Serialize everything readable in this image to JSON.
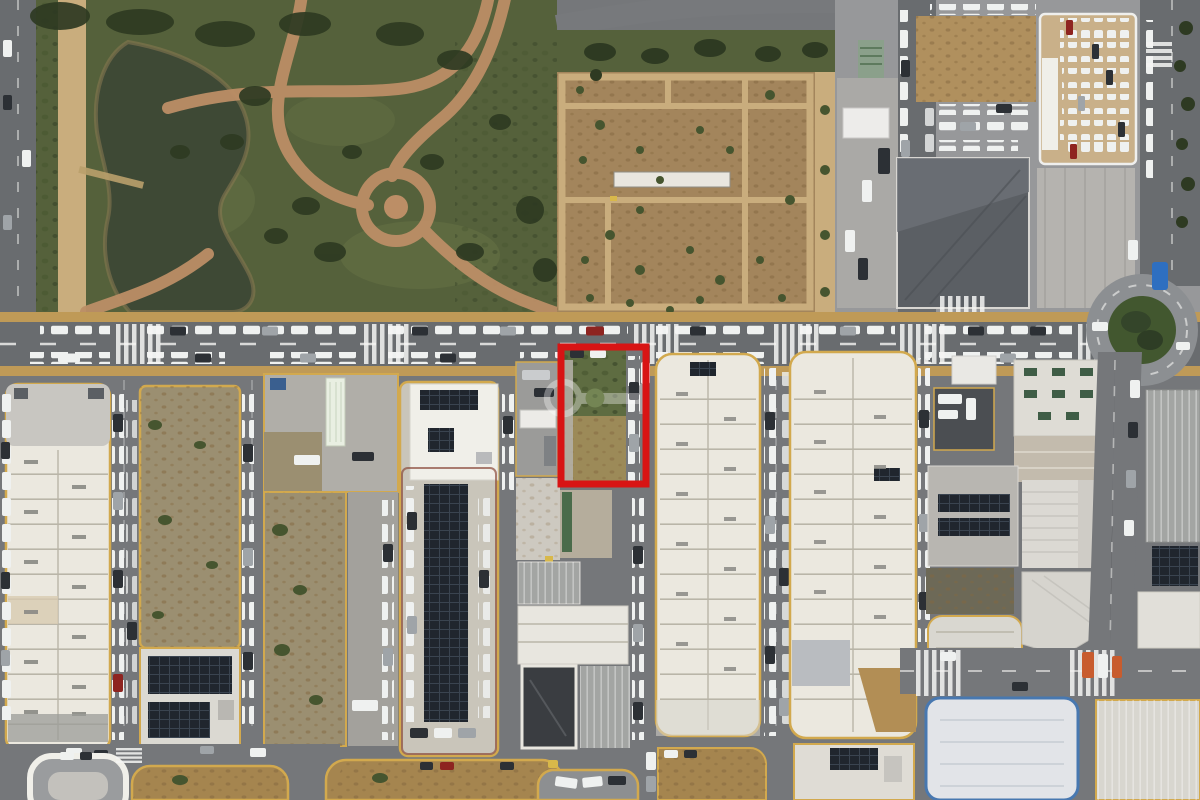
{
  "meta": {
    "type": "aerial-drone-photograph",
    "description": "Aerial top-down photograph of an industrial and commercial district next to a landscaped park with a pond and a large bare-earth field; long cream warehouse rows line streets full of parked cars; a vacant overgrown plot beside the main avenue is outlined with a thick red rectangle and a faint key-shaped watermark overlays it; a roundabout with a planted island sits at the right edge.",
    "width_px": 1200,
    "height_px": 800
  },
  "annotation": {
    "label": "highlighted-plot-outline",
    "shape": "rectangle",
    "color": "#d81414",
    "stroke_width_px": 7,
    "x": 561,
    "y": 347,
    "width": 85,
    "height": 137
  },
  "watermark": {
    "label": "key-logo-watermark",
    "shape": "key ring with shaft and round bit",
    "color": "#ffffff",
    "accent_color": "#9db478",
    "opacity": 0.35
  },
  "colors": {
    "asphalt": "#75777a",
    "road-dark": "#696c6f",
    "sidewalk-tan": "#bf9a57",
    "curb-yellow": "#d2a94e",
    "park-grass": "#55613b",
    "park-grass-light": "#6a7648",
    "tree-dark": "#2e3a22",
    "tree-mid": "#46552f",
    "pond-water": "#3e4935",
    "path-brick": "#bc8e66",
    "path-light": "#c9ad7d",
    "dirt-field": "#a3855c",
    "dirt-speckle": "#84683f",
    "dirt-lot": "#9b8f71",
    "dirt-lot-dark": "#6d6957",
    "dirt-tan": "#a5854f",
    "roof-cream": "#ebe8df",
    "roof-white": "#f0efe9",
    "roof-gray": "#c8c6c1",
    "roof-gray-dark": "#5b5f64",
    "roof-rib-gray": "#a3a5a3",
    "roof-tan": "#b28e55",
    "roof-deck-tan": "#c9b089",
    "seg-line": "#b9b5a8",
    "vent-gray": "#8a8a85",
    "solar-dark": "#20262e",
    "solar-line": "#3a4450",
    "skylight-green": "#3f5d46",
    "concrete": "#c9c5ba",
    "concrete-light": "#dcdad4",
    "car-white": "#eff1f0",
    "car-dark": "#2c3035",
    "car-silver": "#9fa4a8",
    "car-red": "#8e2420",
    "car-blue": "#2e6fc0",
    "car-yellow": "#d8b84a",
    "truck-orange": "#c85c2e",
    "lane-white": "#f5f5f3",
    "blue-trim": "#4878b0",
    "wall-red": "#8a4a3a",
    "annotation-red": "#d81414",
    "watermark-white": "#ffffff",
    "watermark-green": "#9db478"
  },
  "regions": [
    {
      "name": "park",
      "description": "Landscaped park with winding brick paths, circular plaza, lawns and tree clusters"
    },
    {
      "name": "pond",
      "description": "Curved pond with dark green water and a small footbridge"
    },
    {
      "name": "dirt-field",
      "description": "Large bare-earth field divided by light footpaths, scattered young trees and one long white structure"
    },
    {
      "name": "commercial-north-east",
      "description": "Retail buildings, a bare lot, ground parking rows and a building with rooftop parking full of cars"
    },
    {
      "name": "roundabout",
      "description": "Road roundabout with planted green centre island"
    },
    {
      "name": "main-avenue",
      "description": "Main east-west avenue with parked vehicles, dashed lane markings and zebra crossings"
    },
    {
      "name": "industrial-blocks",
      "description": "Rows of long cream warehouse buildings with segmented roofs separated by streets lined with parked cars"
    },
    {
      "name": "vacant-plot",
      "description": "Overgrown vacant plot highlighted by the red rectangle"
    },
    {
      "name": "solar-roofs",
      "description": "Several roofs and carports covered with dark photovoltaic panel arrays"
    }
  ]
}
